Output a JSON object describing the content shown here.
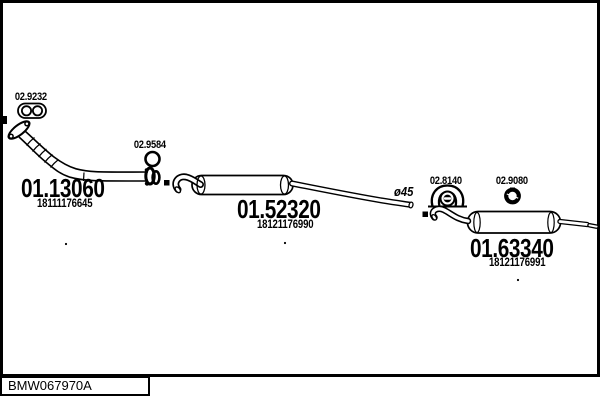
{
  "diagram": {
    "drawing_code": "BMW067970A",
    "pipe_diameter_note": "ø45",
    "parts": {
      "flange_gasket": {
        "code": "02.9232"
      },
      "clamp": {
        "code": "02.9584"
      },
      "front_pipe": {
        "code": "01.13060",
        "oem": "18111176645"
      },
      "centre_muffler": {
        "code": "01.52320",
        "oem": "18121176990"
      },
      "rubber_mount": {
        "code": "02.8140"
      },
      "rubber_ring": {
        "code": "02.9080"
      },
      "rear_muffler": {
        "code": "01.63340",
        "oem": "18121176991"
      }
    }
  }
}
